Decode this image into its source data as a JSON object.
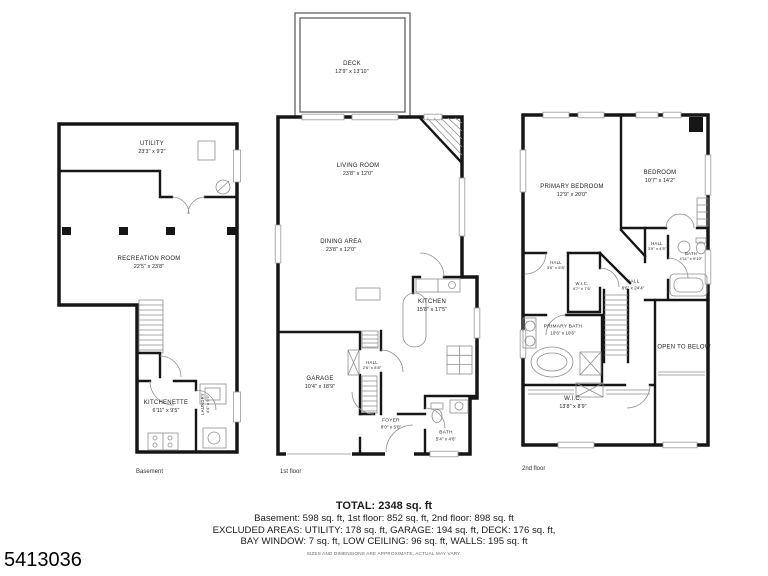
{
  "listing_id": "5413036",
  "plans": {
    "basement": {
      "caption": "Basement",
      "rooms": {
        "utility": {
          "name": "UTILITY",
          "dims": "23'3\" x 9'2\""
        },
        "recreation": {
          "name": "RECREATION ROOM",
          "dims": "22'5\" x 23'8\""
        },
        "kitchenette": {
          "name": "KITCHENETTE",
          "dims": "6'11\" x 9'5\""
        },
        "laundry": {
          "name": "LAUNDRY",
          "dims": "4'4\" x 9'5\""
        }
      }
    },
    "first_floor": {
      "caption": "1st floor",
      "rooms": {
        "deck": {
          "name": "DECK",
          "dims": "12'9\" x 13'10\""
        },
        "living": {
          "name": "LIVING ROOM",
          "dims": "23'8\" x 12'0\""
        },
        "dining": {
          "name": "DINING AREA",
          "dims": "23'8\" x 12'0\""
        },
        "kitchen": {
          "name": "KITCHEN",
          "dims": "15'8\" x 17'5\""
        },
        "garage": {
          "name": "GARAGE",
          "dims": "10'4\" x 18'9\""
        },
        "hall": {
          "name": "HALL",
          "dims": "2'6\" x 8'8\""
        },
        "foyer": {
          "name": "FOYER",
          "dims": "8'0\" x 5'0\""
        },
        "bath": {
          "name": "BATH",
          "dims": "5'4\" x 4'6\""
        }
      }
    },
    "second_floor": {
      "caption": "2nd floor",
      "rooms": {
        "primary_bedroom": {
          "name": "PRIMARY BEDROOM",
          "dims": "12'9\" x 20'0\""
        },
        "bedroom": {
          "name": "BEDROOM",
          "dims": "10'7\" x 14'2\""
        },
        "hall_left": {
          "name": "HALL",
          "dims": "3'6\" x 5'8\""
        },
        "wic_small": {
          "name": "W.I.C.",
          "dims": "4'7\" x 7'6\""
        },
        "hall_main": {
          "name": "HALL",
          "dims": "8'6\" x 24'4\""
        },
        "hall_small": {
          "name": "HALL",
          "dims": "3'9\" x 4'5\""
        },
        "bath": {
          "name": "BATH",
          "dims": "4'11\" x 9'10\""
        },
        "primary_bath": {
          "name": "PRIMARY BATH",
          "dims": "10'6\" x 10'6\""
        },
        "open_below": {
          "name": "OPEN TO BELOW",
          "dims": ""
        },
        "wic_large": {
          "name": "W.I.C.",
          "dims": "13'8\" x 8'9\""
        }
      }
    }
  },
  "summary": {
    "total": "TOTAL: 2348 sq. ft",
    "floors": "Basement: 598 sq. ft, 1st floor: 852 sq. ft, 2nd floor: 898 sq. ft",
    "excluded1": "EXCLUDED AREAS: UTILITY: 178 sq. ft, GARAGE: 194 sq. ft, DECK: 176 sq. ft,",
    "excluded2": "BAY WINDOW: 7 sq. ft, LOW CEILING: 96 sq. ft, WALLS: 195 sq. ft",
    "disclaimer": "SIZES AND DIMENSIONS ARE APPROXIMATE, ACTUAL MAY VARY."
  },
  "colors": {
    "wall": "#161616",
    "thin_line": "#8f8f8f",
    "background": "#ffffff"
  }
}
